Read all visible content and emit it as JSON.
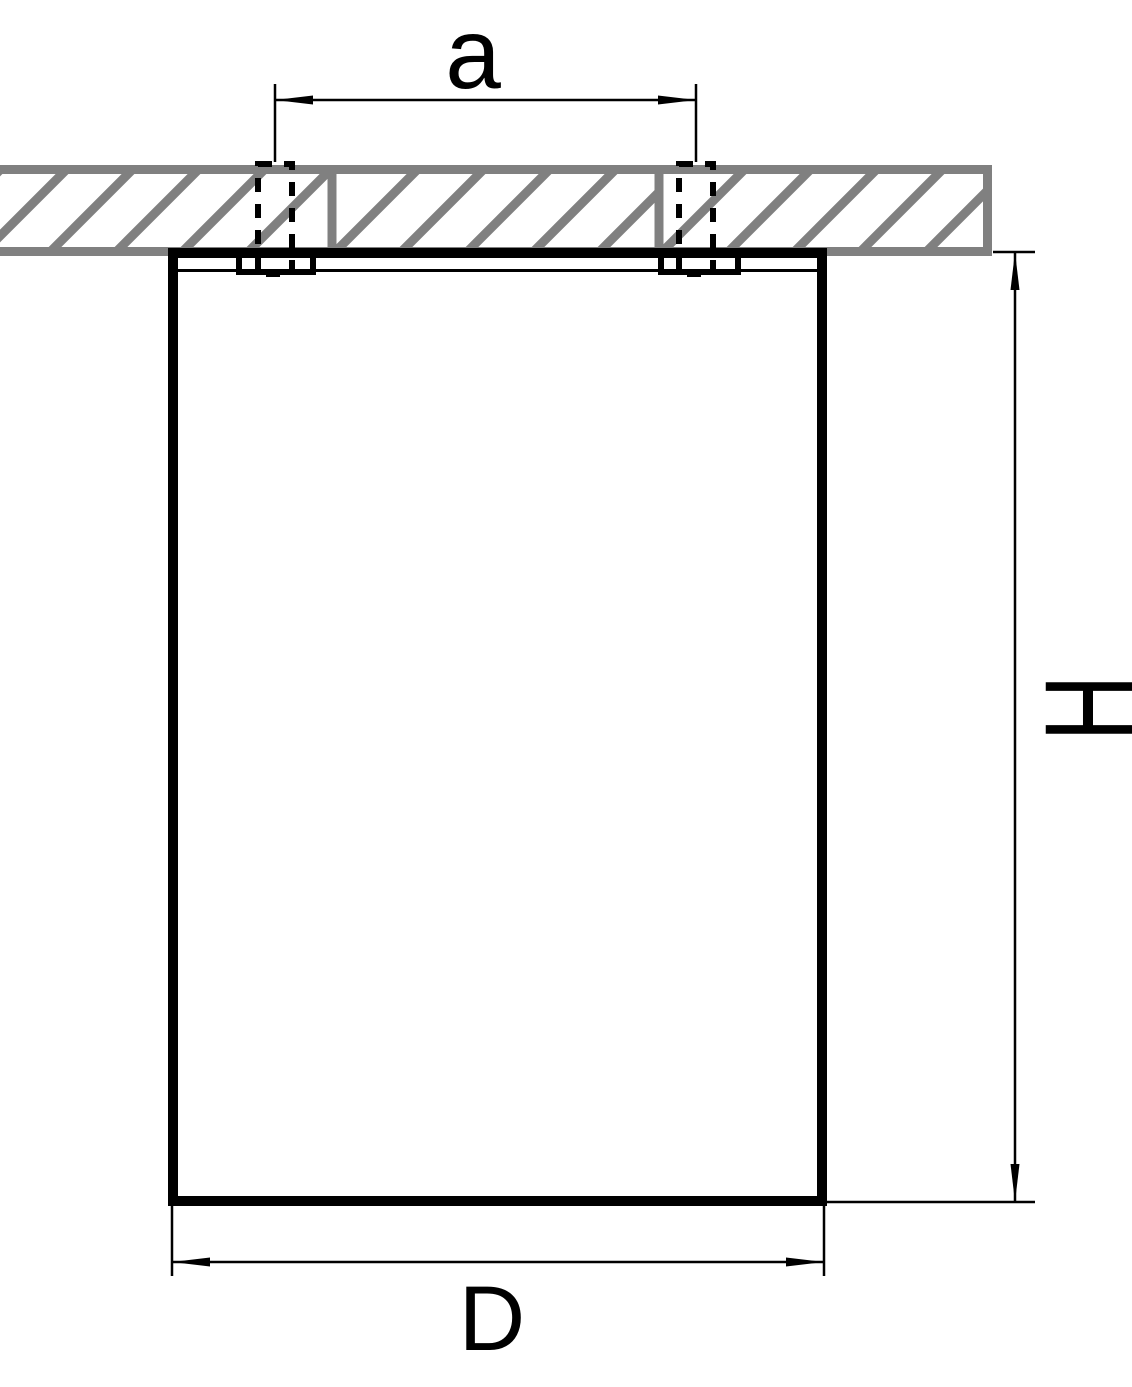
{
  "drawing": {
    "type": "dimension-diagram",
    "labels": {
      "hole_spacing": "a",
      "height": "H",
      "diameter": "D"
    }
  },
  "colors": {
    "line": "#000000",
    "hatch": "#808080",
    "background": "#ffffff"
  }
}
